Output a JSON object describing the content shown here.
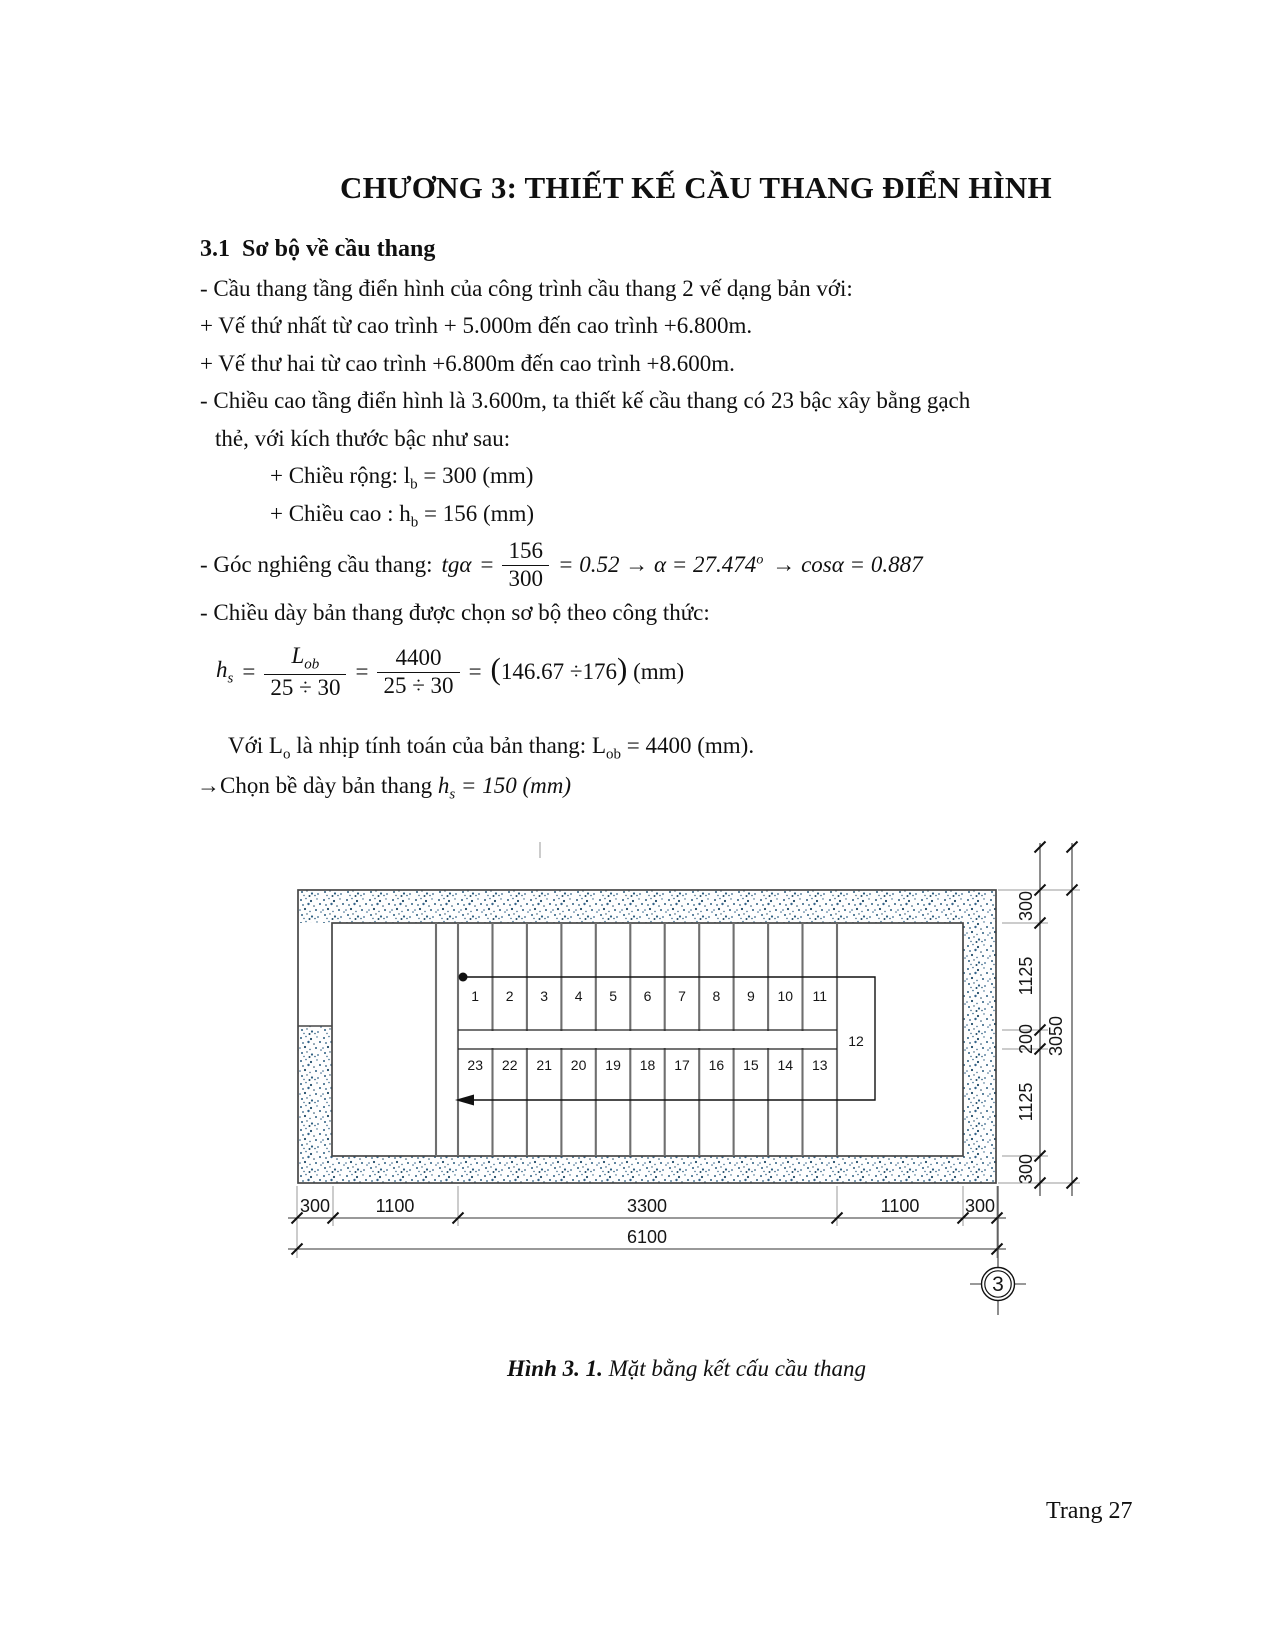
{
  "title": "CHƯƠNG 3: THIẾT KẾ CẦU THANG ĐIỂN HÌNH",
  "section": {
    "number": "3.1",
    "heading": "Sơ bộ về cầu thang"
  },
  "body": {
    "line1": "- Cầu thang tầng điển hình của công trình cầu thang 2 vế dạng bản với:",
    "line2": "+ Vế thứ nhất từ cao trình + 5.000m đến cao trình +6.800m.",
    "line3": "+ Vế thư hai từ cao trình +6.800m đến cao trình +8.600m.",
    "line4": "- Chiều cao tầng điển hình là 3.600m, ta thiết kế cầu thang có 23 bậc xây bằng gạch",
    "line5": "thẻ, với kích thước bậc như sau:",
    "width_item": {
      "pre": "+ Chiều rộng: l",
      "sub": "b",
      "post": " = 300 (mm)"
    },
    "height_item": {
      "pre": "+ Chiều cao : h",
      "sub": "b",
      "post": " = 156 (mm)"
    },
    "angle": {
      "label": "- Góc nghiêng cầu thang:",
      "tg": "tgα",
      "eq": "=",
      "num": "156",
      "den": "300",
      "mid": "= 0.52 → α = 27.474",
      "sup": "o",
      "tail": "→ cosα = 0.887"
    },
    "thickness_intro": "- Chiều dày bản thang được chọn sơ bộ theo công thức:",
    "hs_formula": {
      "h": "h",
      "hsub": "s",
      "eq1": "=",
      "f1num": "L",
      "f1sub": "ob",
      "f1den": "25 ÷ 30",
      "eq2": "=",
      "f2num": "4400",
      "f2den": "25 ÷ 30",
      "eq3": "=",
      "lp": "(",
      "result": "146.67 ÷176",
      "rp": ")",
      "unit": " (mm)"
    },
    "lo_note": {
      "p1": "Với L",
      "s1": "o",
      "p2": " là nhịp tính toán của bản thang: L",
      "s2": "ob",
      "p3": " = 4400 (mm)."
    },
    "choose": {
      "arrow": "→",
      "text": "Chọn bề dày bản thang ",
      "h": "h",
      "hsub": "s",
      "tail": " = 150 (mm)"
    }
  },
  "figure": {
    "caption": {
      "label": "Hình 3. 1.",
      "text": " Mặt bằng kết cấu cầu thang"
    },
    "top_steps": [
      "1",
      "2",
      "3",
      "4",
      "5",
      "6",
      "7",
      "8",
      "9",
      "10",
      "11"
    ],
    "bottom_steps": [
      "23",
      "22",
      "21",
      "20",
      "19",
      "18",
      "17",
      "16",
      "15",
      "14",
      "13"
    ],
    "landing_step": "12",
    "dims_bottom": [
      "300",
      "1100",
      "3300",
      "1100",
      "300"
    ],
    "dim_bottom_total": "6100",
    "dims_right": [
      "300",
      "1125",
      "200",
      "1125",
      "300"
    ],
    "dim_right_total": "3050",
    "grid_bubble": "3",
    "colors": {
      "stipple": "#2c5d7f",
      "wall_line": "#474747",
      "tread_line": "#6f6f6f",
      "dim_line": "#333333"
    }
  },
  "page": {
    "number_label": "Trang 27"
  }
}
